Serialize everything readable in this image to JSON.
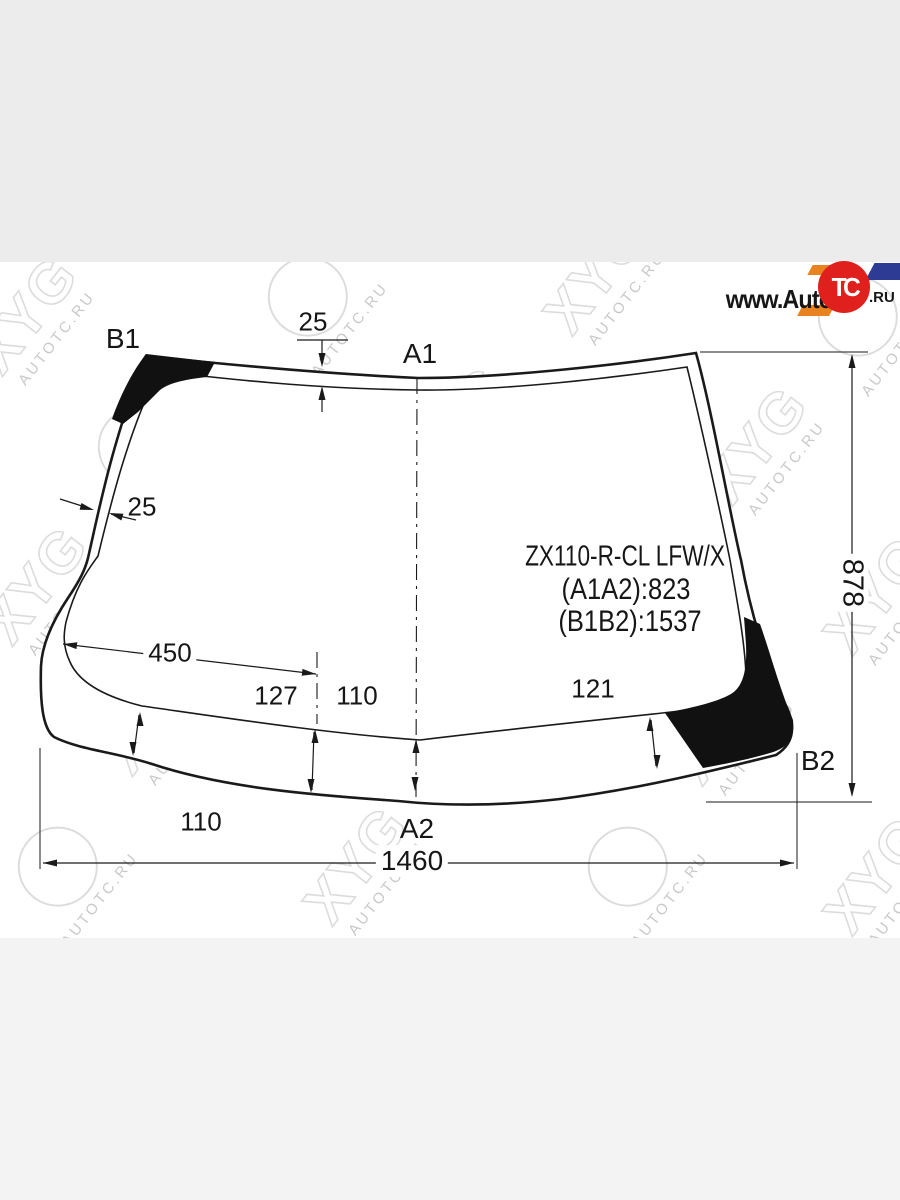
{
  "brand": {
    "prefix": "www.Auto",
    "circle": "TC",
    "suffix": ".RU"
  },
  "watermark": {
    "logo": "XYG",
    "url": "AUTOTC.RU"
  },
  "diagram": {
    "part_number": "ZX110-R-CL LFW/X",
    "dim_a1a2": "(A1A2):823",
    "dim_b1b2": "(B1B2):1537",
    "corners": {
      "a1": "A1",
      "a2": "A2",
      "b1": "B1",
      "b2": "B2"
    },
    "dims": {
      "top_band": "25",
      "left_band": "25",
      "offset_left": "450",
      "band_left_mid": "127",
      "band_center": "110",
      "band_right": "121",
      "band_left_low": "110",
      "total_width": "1460",
      "total_height": "878"
    }
  },
  "colors": {
    "line": "#1a1a1a",
    "band_top": "#ececec",
    "band_bottom": "#f3f3f3",
    "watermark": "#dcdcdc",
    "brand_red": "#e0201d",
    "brand_orange": "#e8831f",
    "brand_blue": "#2e3b94"
  }
}
